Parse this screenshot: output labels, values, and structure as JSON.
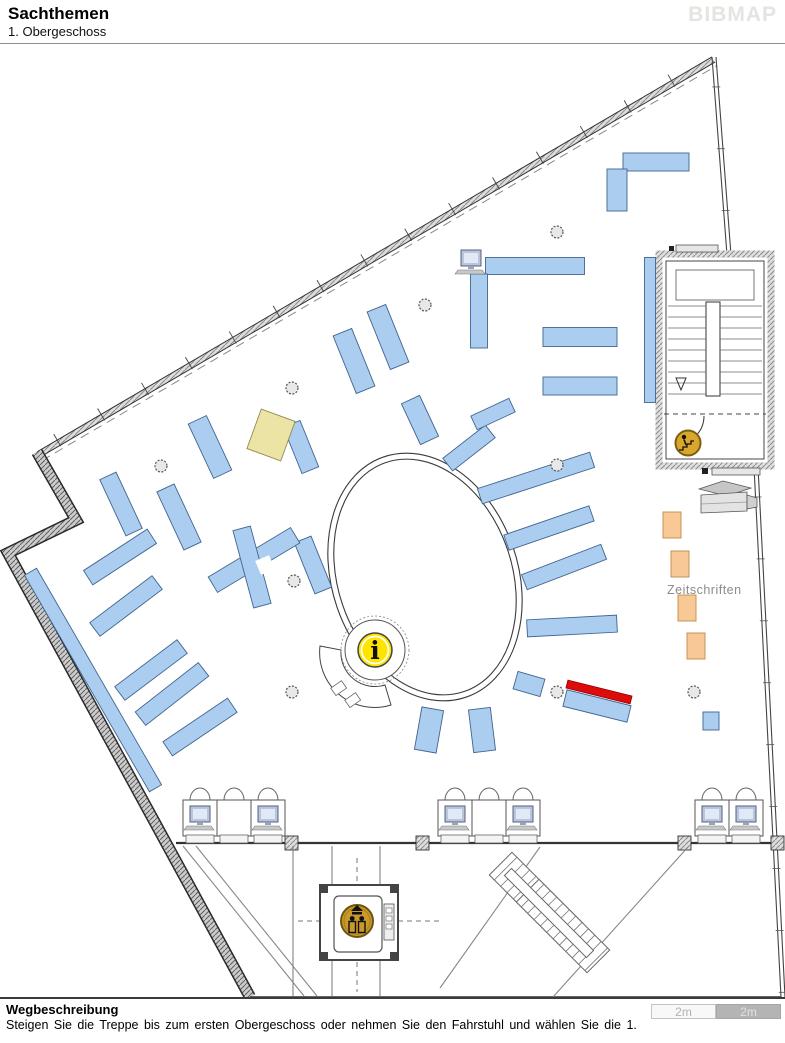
{
  "header": {
    "title": "Sachthemen",
    "subtitle": "1. Obergeschoss",
    "logo": "BIBMAP"
  },
  "footer": {
    "heading": "Wegbeschreibung",
    "text": "Steigen Sie die Treppe bis zum ersten Obergeschoss oder nehmen Sie den Fahrstuhl und wählen Sie die 1.",
    "scale_left": "2m",
    "scale_right": "2m"
  },
  "map": {
    "label": {
      "text": "Zeitschriften",
      "x": 667,
      "y": 594,
      "color": "#8c8c8c",
      "size": 12.5
    },
    "shelf_colors": {
      "default": {
        "fill": "#aacdf0",
        "stroke": "#41648f"
      },
      "special": {
        "fill": "#ece4a4",
        "stroke": "#8f8a56"
      },
      "magazine": {
        "fill": "#f9c897",
        "stroke": "#c08a48"
      },
      "highlight": {
        "fill": "#dd0c0c",
        "stroke": "#990000"
      }
    },
    "shelves": [
      {
        "cx": 656,
        "cy": 162,
        "w": 66,
        "h": 18,
        "r": 0
      },
      {
        "cx": 617,
        "cy": 190,
        "w": 20,
        "h": 42,
        "r": 0
      },
      {
        "cx": 535,
        "cy": 266,
        "w": 99,
        "h": 17,
        "r": 0
      },
      {
        "cx": 479,
        "cy": 311,
        "w": 17,
        "h": 74,
        "r": 0
      },
      {
        "cx": 580,
        "cy": 337,
        "w": 74,
        "h": 19,
        "r": 0
      },
      {
        "cx": 580,
        "cy": 386,
        "w": 74,
        "h": 18,
        "r": 0
      },
      {
        "cx": 650,
        "cy": 330,
        "w": 11,
        "h": 145,
        "r": 0
      },
      {
        "cx": 354,
        "cy": 361,
        "w": 20,
        "h": 62,
        "r": -22
      },
      {
        "cx": 388,
        "cy": 337,
        "w": 20,
        "h": 62,
        "r": -22
      },
      {
        "cx": 301,
        "cy": 447,
        "w": 18,
        "h": 50,
        "r": -22
      },
      {
        "cx": 210,
        "cy": 447,
        "w": 20,
        "h": 60,
        "r": -25
      },
      {
        "cx": 179,
        "cy": 517,
        "w": 19,
        "h": 64,
        "r": -25
      },
      {
        "cx": 121,
        "cy": 504,
        "w": 18,
        "h": 62,
        "r": -25
      },
      {
        "cx": 120,
        "cy": 557,
        "w": 76,
        "h": 17,
        "r": -33
      },
      {
        "cx": 420,
        "cy": 420,
        "w": 20,
        "h": 45,
        "r": -25
      },
      {
        "cx": 313,
        "cy": 565,
        "w": 18,
        "h": 55,
        "r": -22
      },
      {
        "cx": 271,
        "cy": 435,
        "w": 36,
        "h": 42,
        "r": 20,
        "type": "special"
      },
      {
        "cx": 254,
        "cy": 560,
        "w": 96,
        "h": 18,
        "r": -31
      },
      {
        "cx": 252,
        "cy": 567,
        "w": 18,
        "h": 80,
        "r": -15
      },
      {
        "cx": 126,
        "cy": 606,
        "w": 78,
        "h": 17,
        "r": -37
      },
      {
        "cx": 151,
        "cy": 670,
        "w": 78,
        "h": 17,
        "r": -37
      },
      {
        "cx": 172,
        "cy": 694,
        "w": 80,
        "h": 17,
        "r": -38
      },
      {
        "cx": 200,
        "cy": 727,
        "w": 78,
        "h": 17,
        "r": -34
      },
      {
        "cx": 93,
        "cy": 680,
        "w": 14,
        "h": 250,
        "r": -30
      },
      {
        "cx": 469,
        "cy": 448,
        "w": 54,
        "h": 16,
        "r": -38
      },
      {
        "cx": 536,
        "cy": 478,
        "w": 118,
        "h": 16,
        "r": -18
      },
      {
        "cx": 549,
        "cy": 528,
        "w": 90,
        "h": 16,
        "r": -19
      },
      {
        "cx": 564,
        "cy": 567,
        "w": 85,
        "h": 16,
        "r": -21
      },
      {
        "cx": 572,
        "cy": 626,
        "w": 90,
        "h": 17,
        "r": -3
      },
      {
        "cx": 529,
        "cy": 684,
        "w": 28,
        "h": 18,
        "r": 16
      },
      {
        "cx": 597,
        "cy": 706,
        "w": 66,
        "h": 17,
        "r": 14
      },
      {
        "cx": 429,
        "cy": 730,
        "w": 22,
        "h": 43,
        "r": 10
      },
      {
        "cx": 482,
        "cy": 730,
        "w": 22,
        "h": 43,
        "r": -7
      },
      {
        "cx": 493,
        "cy": 414,
        "w": 42,
        "h": 15,
        "r": -25
      },
      {
        "cx": 711,
        "cy": 721,
        "w": 16,
        "h": 18,
        "r": 0
      },
      {
        "cx": 672,
        "cy": 525,
        "w": 18,
        "h": 26,
        "r": 0,
        "type": "magazine"
      },
      {
        "cx": 680,
        "cy": 564,
        "w": 18,
        "h": 26,
        "r": 0,
        "type": "magazine"
      },
      {
        "cx": 687,
        "cy": 608,
        "w": 18,
        "h": 26,
        "r": 0,
        "type": "magazine"
      },
      {
        "cx": 696,
        "cy": 646,
        "w": 18,
        "h": 26,
        "r": 0,
        "type": "magazine"
      },
      {
        "cx": 599,
        "cy": 692,
        "w": 66,
        "h": 8,
        "r": 14,
        "type": "highlight"
      }
    ],
    "cross_gap": {
      "cx": 265,
      "cy": 565,
      "w": 15,
      "h": 15,
      "r": -23
    },
    "columns": [
      [
        292,
        388
      ],
      [
        557,
        232
      ],
      [
        161,
        466
      ],
      [
        294,
        581
      ],
      [
        292,
        692
      ],
      [
        557,
        692
      ],
      [
        694,
        692
      ],
      [
        557,
        465
      ],
      [
        425,
        305
      ]
    ],
    "pillars": [
      291,
      422,
      684,
      777
    ],
    "walls": {
      "ne": [
        [
          37,
          452
        ],
        [
          712,
          57
        ]
      ],
      "left": [
        [
          37,
          452
        ],
        [
          76,
          520
        ],
        [
          8,
          553
        ],
        [
          250,
          997
        ]
      ],
      "right_a": [
        [
          712,
          57
        ],
        [
          727,
          255
        ]
      ],
      "right_b": [
        [
          754,
          467
        ],
        [
          781,
          997
        ]
      ],
      "bottom": [
        [
          250,
          997
        ],
        [
          781,
          997
        ]
      ],
      "mid": [
        [
          176,
          843
        ],
        [
          783,
          843
        ]
      ],
      "verticals": [
        293,
        332,
        380
      ],
      "diagonals": [
        [
          [
            183,
            846
          ],
          [
            304,
            996
          ]
        ],
        [
          [
            196,
            846
          ],
          [
            317,
            996
          ]
        ],
        [
          [
            540,
            847
          ],
          [
            440,
            988
          ]
        ],
        [
          [
            688,
            847
          ],
          [
            553,
            997
          ]
        ]
      ]
    },
    "oval": {
      "cx": 425,
      "cy": 577,
      "rx": 93,
      "ry": 127,
      "rot": -19
    },
    "info": {
      "cx": 375,
      "cy": 650,
      "icon_r": 17,
      "glyph": "i",
      "fill": "#ffe400"
    },
    "stairs_icon": {
      "cx": 688,
      "cy": 443,
      "r": 12.5,
      "fill": "#d8a72c"
    },
    "stairwell": {
      "x": 657,
      "y": 252,
      "w": 116,
      "h": 216
    },
    "elevator": {
      "x": 320,
      "y": 885,
      "w": 78,
      "h": 75,
      "icon": {
        "cx": 357,
        "cy": 921,
        "r": 16,
        "fill": "#c9992b"
      }
    },
    "lower_stairs": {
      "flights": [
        {
          "cx": 536,
          "cy": 899
        },
        {
          "cx": 563,
          "cy": 926
        }
      ],
      "fw": 100,
      "fh": 32,
      "rot": 45,
      "stringer": {
        "cx": 549,
        "cy": 913,
        "w": 116,
        "h": 10
      }
    },
    "desk_groups": [
      {
        "x": 183,
        "units": 3,
        "pcs": [
          0,
          2
        ]
      },
      {
        "x": 438,
        "units": 3,
        "pcs": [
          0,
          2
        ]
      },
      {
        "x": 695,
        "units": 2,
        "pcs": [
          0,
          1
        ]
      }
    ],
    "top_pc": {
      "x": 461,
      "y": 250
    },
    "copier": {
      "x": 699,
      "y": 481
    }
  }
}
